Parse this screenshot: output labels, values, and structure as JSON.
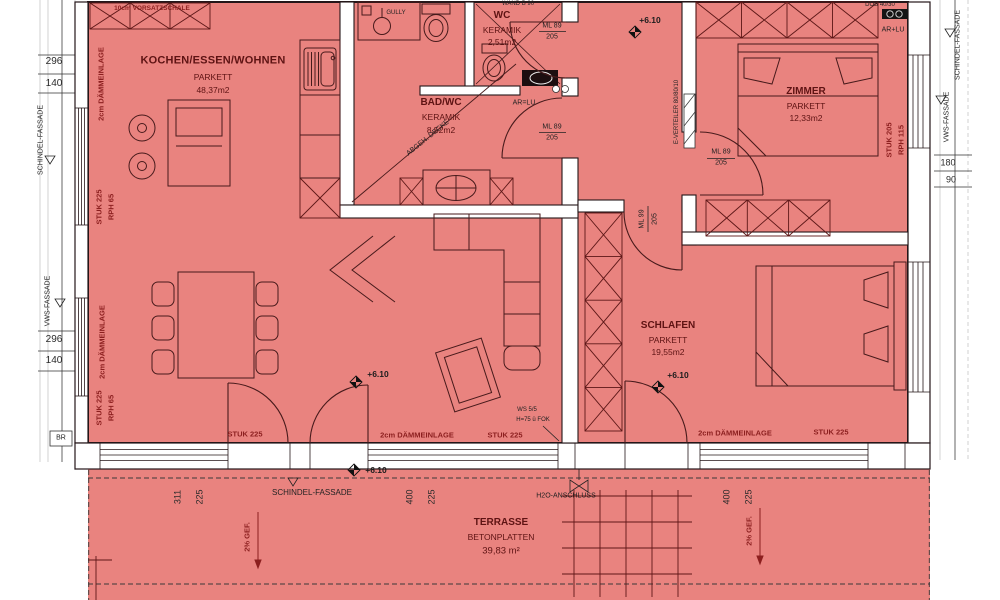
{
  "rooms": {
    "wohnen": {
      "name": "KOCHEN/ESSEN/WOHNEN",
      "floor": "PARKETT",
      "area": "48,37m2"
    },
    "bad": {
      "name": "BAD/WC",
      "floor": "KERAMIK",
      "area": "8,52m2"
    },
    "wc": {
      "name": "WC",
      "floor": "KERAMIK",
      "area": "2,51m2"
    },
    "zimmer": {
      "name": "ZIMMER",
      "floor": "PARKETT",
      "area": "12,33m2"
    },
    "schlafen": {
      "name": "SCHLAFEN",
      "floor": "PARKETT",
      "area": "19,55m2"
    },
    "terrasse": {
      "name": "TERRASSE",
      "floor": "BETONPLATTEN",
      "area": "39,83 m²"
    }
  },
  "elevation": {
    "value": "+6.10"
  },
  "doors": {
    "ml89": "ML 89",
    "ml99": "ML 99",
    "height": "205"
  },
  "walls": {
    "vorsatzschale": "10cm VORSATZSCHALE",
    "daemmeinlage": "2cm DÄMMEINLAGE",
    "wand_b90": "WAND B 90"
  },
  "windows": {
    "stuk225": "STUK 225",
    "rph65": "RPH 65",
    "stuk205": "STUK 205",
    "rph115": "RPH 115",
    "ws55": "WS 5/5",
    "ws_h": "H=75 ü FOK",
    "br": "BR"
  },
  "facade": {
    "schindel": "SCHINDEL-FASSADE",
    "vws": "VWS-FASSADE"
  },
  "tech": {
    "everteiler": "E-VERTEILER 80/80/10",
    "h2o": "H2O-ANSCHLUSS",
    "gully": "GULLY",
    "ar_lu_plus": "AR+LU",
    "ar_lu_eq": "AR=LU",
    "abgeh_decke": "ABGEH. DECKE",
    "dob": "DOB 40/30",
    "gefaelle": "2% GEF."
  },
  "dims": {
    "d296": "296",
    "d140": "140",
    "d311": "311",
    "d225": "225",
    "d400": "400",
    "d180": "180",
    "d90": "90"
  },
  "colors": {
    "room_fill": "#e9837f",
    "annotation_red": "#8c1f1f",
    "wall_line": "#241619"
  }
}
